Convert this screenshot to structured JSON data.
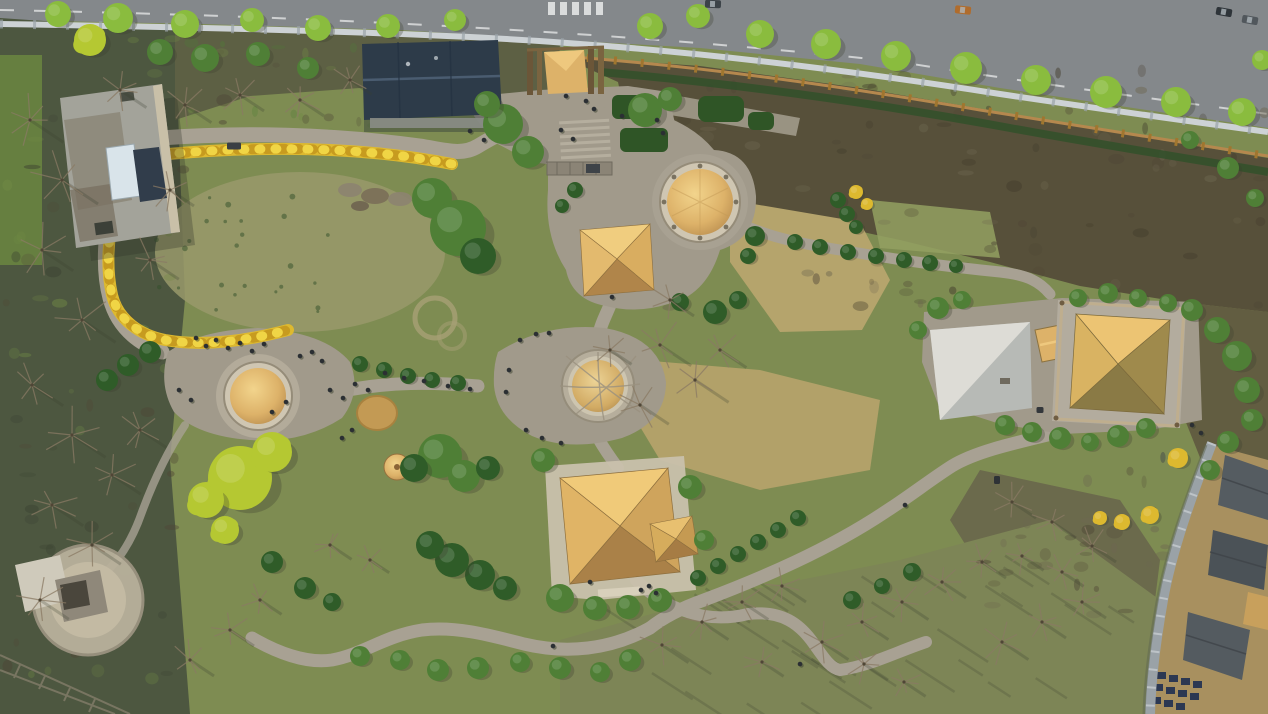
{
  "meta": {
    "description": "Aerial drone photograph of a prehistoric heritage park with thatched pit-house reconstructions, winding stone paths, a yellow forsythia hedge loop, a riverside road at top, woodland at left and a traditional village at bottom right",
    "no_visible_text": true
  },
  "palette": {
    "grass": "#7e8c52",
    "grass_light": "#93a061",
    "meadow_worn": "#99996b",
    "tan_dry": "#b5a46c",
    "woods": "#4d5740",
    "woods_light": "#718b45",
    "scrub": "#57503a",
    "scrub_dark": "#423c2c",
    "scrub_light": "#6e6750",
    "road": "#84888b",
    "road_line": "#e8eaea",
    "guardrail": "#cdd2d5",
    "fence_wood": "#b5884e",
    "hedge_dark": "#31502a",
    "path": "#a8a193",
    "plaza": "#a19a8b",
    "stone": "#cfc6b2",
    "ring_stroke": "#958c79",
    "thatch_light": "#f2d48c",
    "thatch": "#ddb269",
    "thatch_dark": "#b5894c",
    "thatch_shadow": "#96703c",
    "roof_dark": "#2d3b49",
    "roof_ridge": "#4a5c70",
    "flat_roof": "#a3a39a",
    "flat_roof_worn": "#8a8476",
    "skylight": "#d9e4ea",
    "solar": "#313d4b",
    "platform_light": "#dddcd6",
    "platform_mid": "#b7bab6",
    "wall_gray": "#9aa2a7",
    "village_dirt": "#a8905f",
    "village_roof": "#555c61",
    "village_roof_dark": "#3e4449",
    "tree_green": "#4f7f36",
    "tree_road": "#8abc3e",
    "tree_dark": "#2f5c28",
    "tree_chartreuse": "#b5c832",
    "forsythia": "#ddb92f",
    "forsythia_deep": "#c79b1f",
    "forsythia_bright": "#f0d545",
    "bare_branch": "#8a7a64",
    "bare_dark": "#4f4636",
    "people": "#2b2f33",
    "shadow": "#3a4030",
    "haystack": "#c39a54",
    "pergola": "#8b8476"
  },
  "landmarks": [
    {
      "name": "riverside-road",
      "x": 640,
      "y": 40
    },
    {
      "name": "visitor-building-flat-roof",
      "x": 118,
      "y": 166
    },
    {
      "name": "exhibition-hall-dark-roof",
      "x": 430,
      "y": 80
    },
    {
      "name": "thatched-entrance-gate",
      "x": 566,
      "y": 72
    },
    {
      "name": "forsythia-hedge-loop",
      "x": 280,
      "y": 245
    },
    {
      "name": "round-pit-house-north",
      "x": 700,
      "y": 202
    },
    {
      "name": "pyramid-pit-house-north",
      "x": 615,
      "y": 258
    },
    {
      "name": "round-pit-house-central",
      "x": 598,
      "y": 386
    },
    {
      "name": "round-pit-house-west",
      "x": 258,
      "y": 396
    },
    {
      "name": "haystack-mound",
      "x": 377,
      "y": 413
    },
    {
      "name": "small-thatch-cone",
      "x": 397,
      "y": 467
    },
    {
      "name": "large-pyramid-house-central",
      "x": 618,
      "y": 527
    },
    {
      "name": "large-pyramid-house-east",
      "x": 1120,
      "y": 362
    },
    {
      "name": "stone-platform-east",
      "x": 980,
      "y": 370
    },
    {
      "name": "pavilion-southwest",
      "x": 80,
      "y": 595
    },
    {
      "name": "heritage-village-southeast",
      "x": 1215,
      "y": 580
    }
  ],
  "scene": {
    "trees": [
      [
        58,
        14,
        13,
        "r"
      ],
      [
        118,
        18,
        15,
        "r"
      ],
      [
        185,
        24,
        14,
        "r"
      ],
      [
        252,
        20,
        12,
        "r"
      ],
      [
        318,
        28,
        13,
        "r"
      ],
      [
        388,
        26,
        12,
        "r"
      ],
      [
        455,
        20,
        11,
        "r"
      ],
      [
        650,
        26,
        13,
        "r"
      ],
      [
        698,
        16,
        12,
        "r"
      ],
      [
        760,
        34,
        14,
        "r"
      ],
      [
        826,
        44,
        15,
        "r"
      ],
      [
        896,
        56,
        15,
        "r"
      ],
      [
        966,
        68,
        16,
        "r"
      ],
      [
        1036,
        80,
        15,
        "r"
      ],
      [
        1106,
        92,
        16,
        "r"
      ],
      [
        1176,
        102,
        15,
        "r"
      ],
      [
        1242,
        112,
        14,
        "r"
      ],
      [
        1262,
        60,
        10,
        "r"
      ],
      [
        90,
        40,
        16,
        "c"
      ],
      [
        160,
        52,
        13,
        "g"
      ],
      [
        205,
        58,
        14,
        "g"
      ],
      [
        258,
        54,
        12,
        "g"
      ],
      [
        308,
        68,
        11,
        "g"
      ],
      [
        432,
        198,
        20,
        "g"
      ],
      [
        458,
        228,
        28,
        "g"
      ],
      [
        478,
        256,
        18,
        "d"
      ],
      [
        503,
        124,
        20,
        "g"
      ],
      [
        528,
        152,
        16,
        "g"
      ],
      [
        487,
        104,
        13,
        "g"
      ],
      [
        645,
        110,
        17,
        "g"
      ],
      [
        670,
        99,
        12,
        "g"
      ],
      [
        575,
        190,
        8,
        "d"
      ],
      [
        562,
        206,
        7,
        "d"
      ],
      [
        755,
        236,
        10,
        "d"
      ],
      [
        748,
        256,
        8,
        "d"
      ],
      [
        715,
        312,
        12,
        "d"
      ],
      [
        738,
        300,
        9,
        "d"
      ],
      [
        680,
        302,
        9,
        "d"
      ],
      [
        795,
        242,
        8,
        "d"
      ],
      [
        820,
        247,
        8,
        "d"
      ],
      [
        848,
        252,
        8,
        "d"
      ],
      [
        876,
        256,
        8,
        "d"
      ],
      [
        904,
        260,
        8,
        "d"
      ],
      [
        930,
        263,
        8,
        "d"
      ],
      [
        956,
        266,
        7,
        "d"
      ],
      [
        838,
        200,
        8,
        "d"
      ],
      [
        847,
        214,
        8,
        "d"
      ],
      [
        856,
        227,
        7,
        "d"
      ],
      [
        360,
        364,
        8,
        "d"
      ],
      [
        384,
        370,
        8,
        "d"
      ],
      [
        408,
        376,
        8,
        "d"
      ],
      [
        432,
        380,
        8,
        "d"
      ],
      [
        458,
        383,
        8,
        "d"
      ],
      [
        150,
        352,
        11,
        "d"
      ],
      [
        128,
        365,
        11,
        "d"
      ],
      [
        107,
        380,
        11,
        "d"
      ],
      [
        440,
        456,
        22,
        "g"
      ],
      [
        464,
        476,
        16,
        "g"
      ],
      [
        414,
        468,
        14,
        "d"
      ],
      [
        488,
        468,
        12,
        "d"
      ],
      [
        240,
        478,
        32,
        "c"
      ],
      [
        272,
        452,
        20,
        "c"
      ],
      [
        206,
        500,
        18,
        "c"
      ],
      [
        225,
        530,
        14,
        "c"
      ],
      [
        543,
        460,
        12,
        "g"
      ],
      [
        690,
        487,
        12,
        "g"
      ],
      [
        704,
        540,
        10,
        "g"
      ],
      [
        480,
        575,
        15,
        "d"
      ],
      [
        452,
        560,
        17,
        "d"
      ],
      [
        430,
        545,
        14,
        "d"
      ],
      [
        505,
        588,
        12,
        "d"
      ],
      [
        560,
        598,
        14,
        "g"
      ],
      [
        595,
        608,
        12,
        "g"
      ],
      [
        628,
        607,
        12,
        "g"
      ],
      [
        660,
        600,
        12,
        "g"
      ],
      [
        630,
        660,
        11,
        "g"
      ],
      [
        600,
        672,
        10,
        "g"
      ],
      [
        560,
        668,
        11,
        "g"
      ],
      [
        520,
        662,
        10,
        "g"
      ],
      [
        478,
        668,
        11,
        "g"
      ],
      [
        438,
        670,
        11,
        "g"
      ],
      [
        400,
        660,
        10,
        "g"
      ],
      [
        360,
        656,
        10,
        "g"
      ],
      [
        938,
        308,
        11,
        "g"
      ],
      [
        962,
        300,
        9,
        "g"
      ],
      [
        918,
        330,
        9,
        "g"
      ],
      [
        1005,
        425,
        10,
        "g"
      ],
      [
        1032,
        432,
        10,
        "g"
      ],
      [
        1060,
        438,
        11,
        "g"
      ],
      [
        1090,
        442,
        9,
        "g"
      ],
      [
        1118,
        436,
        11,
        "g"
      ],
      [
        1146,
        428,
        10,
        "g"
      ],
      [
        1078,
        298,
        9,
        "g"
      ],
      [
        1108,
        293,
        10,
        "g"
      ],
      [
        1138,
        298,
        9,
        "g"
      ],
      [
        1168,
        303,
        9,
        "g"
      ],
      [
        1192,
        310,
        11,
        "g"
      ],
      [
        1217,
        330,
        13,
        "g"
      ],
      [
        1237,
        356,
        15,
        "g"
      ],
      [
        1247,
        390,
        13,
        "g"
      ],
      [
        1252,
        420,
        11,
        "g"
      ],
      [
        1228,
        442,
        11,
        "g"
      ],
      [
        1210,
        470,
        10,
        "g"
      ],
      [
        698,
        578,
        8,
        "d"
      ],
      [
        718,
        566,
        8,
        "d"
      ],
      [
        738,
        554,
        8,
        "d"
      ],
      [
        758,
        542,
        8,
        "d"
      ],
      [
        778,
        530,
        8,
        "d"
      ],
      [
        798,
        518,
        8,
        "d"
      ],
      [
        852,
        600,
        9,
        "d"
      ],
      [
        882,
        586,
        8,
        "d"
      ],
      [
        912,
        572,
        9,
        "d"
      ],
      [
        305,
        588,
        11,
        "d"
      ],
      [
        332,
        602,
        9,
        "d"
      ],
      [
        272,
        562,
        11,
        "d"
      ],
      [
        1190,
        140,
        9,
        "g"
      ],
      [
        1228,
        168,
        11,
        "g"
      ],
      [
        1255,
        198,
        9,
        "g"
      ],
      [
        1178,
        458,
        10,
        "y"
      ],
      [
        1150,
        515,
        9,
        "y"
      ],
      [
        1122,
        522,
        8,
        "y"
      ],
      [
        1100,
        518,
        7,
        "y"
      ],
      [
        856,
        192,
        7,
        "y"
      ],
      [
        867,
        204,
        6,
        "y"
      ]
    ],
    "bare_trees": [
      [
        30,
        120,
        28
      ],
      [
        62,
        180,
        30
      ],
      [
        42,
        250,
        26
      ],
      [
        82,
        320,
        28
      ],
      [
        32,
        385,
        26
      ],
      [
        72,
        435,
        28
      ],
      [
        112,
        475,
        24
      ],
      [
        52,
        505,
        26
      ],
      [
        92,
        545,
        24
      ],
      [
        40,
        600,
        24
      ],
      [
        140,
        430,
        22
      ],
      [
        150,
        260,
        24
      ],
      [
        120,
        90,
        22
      ],
      [
        185,
        105,
        22
      ],
      [
        240,
        95,
        20
      ],
      [
        300,
        100,
        20
      ],
      [
        350,
        80,
        18
      ],
      [
        170,
        190,
        20
      ],
      [
        230,
        630,
        20
      ],
      [
        190,
        660,
        20
      ],
      [
        260,
        600,
        18
      ],
      [
        330,
        545,
        18
      ],
      [
        370,
        560,
        16
      ],
      [
        660,
        345,
        26
      ],
      [
        695,
        380,
        28
      ],
      [
        640,
        405,
        24
      ],
      [
        720,
        350,
        22
      ],
      [
        670,
        300,
        20
      ],
      [
        610,
        350,
        18
      ],
      [
        662,
        645,
        22
      ],
      [
        702,
        622,
        22
      ],
      [
        742,
        602,
        22
      ],
      [
        782,
        586,
        20
      ],
      [
        822,
        642,
        22
      ],
      [
        862,
        622,
        22
      ],
      [
        902,
        602,
        22
      ],
      [
        942,
        582,
        20
      ],
      [
        982,
        562,
        20
      ],
      [
        864,
        664,
        20
      ],
      [
        904,
        682,
        18
      ],
      [
        1002,
        642,
        22
      ],
      [
        1042,
        622,
        20
      ],
      [
        1082,
        602,
        20
      ],
      [
        762,
        662,
        18
      ],
      [
        1012,
        502,
        20
      ],
      [
        1052,
        522,
        20
      ],
      [
        1092,
        546,
        20
      ],
      [
        1062,
        572,
        18
      ],
      [
        1022,
        556,
        18
      ]
    ],
    "people": [
      [
        196,
        338
      ],
      [
        206,
        346
      ],
      [
        216,
        340
      ],
      [
        228,
        348
      ],
      [
        240,
        343
      ],
      [
        252,
        351
      ],
      [
        264,
        344
      ],
      [
        300,
        356
      ],
      [
        312,
        352
      ],
      [
        322,
        361
      ],
      [
        286,
        402
      ],
      [
        272,
        412
      ],
      [
        191,
        400
      ],
      [
        179,
        390
      ],
      [
        330,
        390
      ],
      [
        343,
        398
      ],
      [
        355,
        384
      ],
      [
        368,
        390
      ],
      [
        385,
        373
      ],
      [
        404,
        378
      ],
      [
        424,
        381
      ],
      [
        448,
        386
      ],
      [
        470,
        389
      ],
      [
        352,
        430
      ],
      [
        342,
        438
      ],
      [
        520,
        340
      ],
      [
        536,
        334
      ],
      [
        549,
        333
      ],
      [
        509,
        370
      ],
      [
        506,
        392
      ],
      [
        526,
        430
      ],
      [
        542,
        438
      ],
      [
        561,
        443
      ],
      [
        561,
        130
      ],
      [
        573,
        139
      ],
      [
        586,
        101
      ],
      [
        594,
        109
      ],
      [
        622,
        116
      ],
      [
        657,
        120
      ],
      [
        663,
        133
      ],
      [
        566,
        96
      ],
      [
        612,
        297
      ],
      [
        590,
        582
      ],
      [
        641,
        590
      ],
      [
        649,
        586
      ],
      [
        656,
        593
      ],
      [
        553,
        646
      ],
      [
        800,
        664
      ],
      [
        905,
        505
      ],
      [
        1192,
        425
      ],
      [
        1201,
        433
      ],
      [
        470,
        131
      ],
      [
        484,
        140
      ]
    ],
    "cars": [
      [
        713,
        4,
        2,
        "#3c4348"
      ],
      [
        963,
        10,
        6,
        "#b06c2c"
      ],
      [
        1224,
        12,
        10,
        "#2e3439"
      ],
      [
        1250,
        20,
        10,
        "#51575c"
      ]
    ],
    "objects": [
      [
        234,
        146,
        14,
        7,
        "#3a3f44"
      ],
      [
        997,
        480,
        6,
        8,
        "#2e3236"
      ],
      [
        1040,
        410,
        7,
        6,
        "#33373b"
      ]
    ],
    "textures": [
      {
        "x": 620,
        "y": 70,
        "w": 648,
        "h": 240,
        "n": 90,
        "type": "speckle",
        "colors": [
          "scrub_dark",
          "scrub_light",
          "bare_dark"
        ]
      },
      {
        "x": 0,
        "y": 30,
        "w": 185,
        "h": 670,
        "n": 60,
        "type": "speckle",
        "colors": [
          "woods_light",
          "bare_dark",
          "shadow"
        ]
      },
      {
        "x": 180,
        "y": 28,
        "w": 240,
        "h": 110,
        "n": 30,
        "type": "speckle",
        "colors": [
          "woods_light",
          "bare_dark",
          "tree_green"
        ]
      },
      {
        "x": 150,
        "y": 185,
        "w": 200,
        "h": 130,
        "n": 26,
        "type": "dots",
        "colors": [
          "hedge_dark"
        ]
      },
      {
        "x": 600,
        "y": 555,
        "w": 540,
        "h": 150,
        "n": 34,
        "type": "strokes",
        "colors": [
          "shadow"
        ]
      },
      {
        "x": 980,
        "y": 470,
        "w": 190,
        "h": 150,
        "n": 26,
        "type": "speckle",
        "colors": [
          "bare_dark",
          "scrub_light"
        ]
      },
      {
        "x": 1150,
        "y": 450,
        "w": 118,
        "h": 264,
        "n": 20,
        "type": "speckle",
        "colors": [
          "village_roof_dark",
          "scrub_light"
        ]
      }
    ]
  }
}
